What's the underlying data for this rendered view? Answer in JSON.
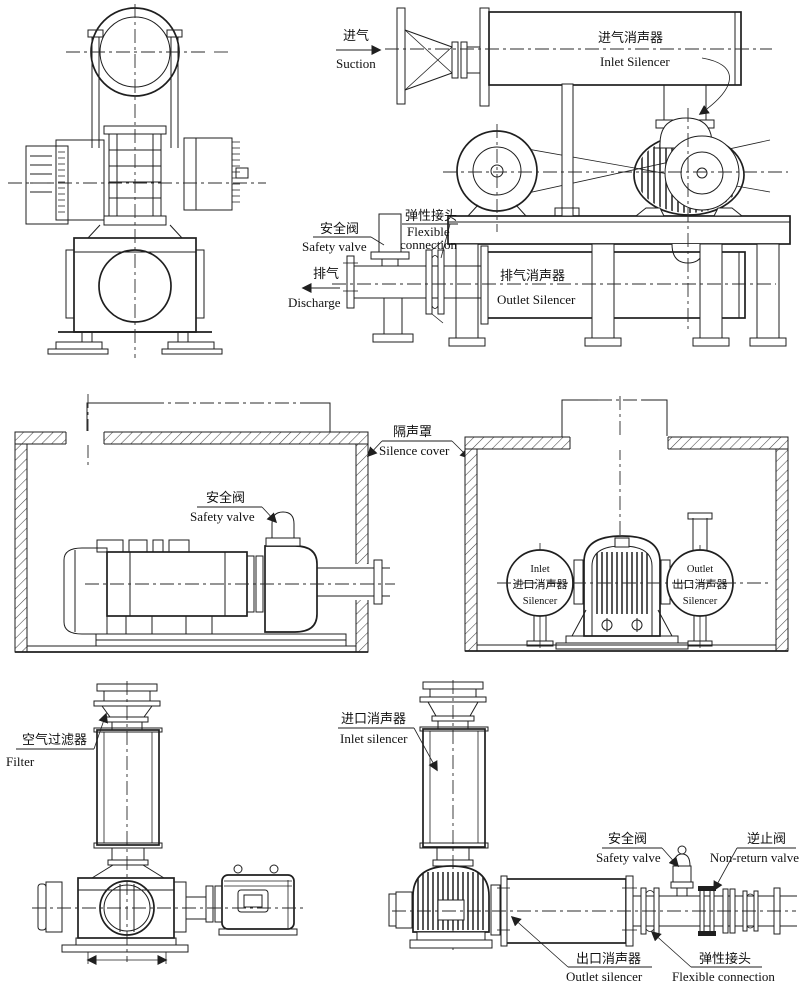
{
  "background": "#ffffff",
  "ink": "#1f1f1f",
  "figures": {
    "side_installation": {
      "suction_cn": "进气",
      "suction_en": "Suction",
      "inlet_silencer_cn": "进气消声器",
      "inlet_silencer_en": "Inlet Silencer",
      "safety_valve_cn": "安全阀",
      "safety_valve_en": "Safety valve",
      "flexible_cn": "弹性接头",
      "flexible_en_line1": "Flexible",
      "flexible_en_line2": "connection",
      "discharge_cn": "排气",
      "discharge_en": "Discharge",
      "outlet_silencer_cn": "排气消声器",
      "outlet_silencer_en": "Outlet Silencer"
    },
    "silence_cover": {
      "cn": "隔声罩",
      "en": "Silence cover"
    },
    "enclosure_left": {
      "safety_valve_cn": "安全阀",
      "safety_valve_en": "Safety valve"
    },
    "enclosure_right": {
      "inlet_line1": "Inlet",
      "inlet_cn": "进口消声器",
      "inlet_line2": "Silencer",
      "outlet_line1": "Outlet",
      "outlet_cn": "出口消声器",
      "outlet_line2": "Silencer"
    },
    "vertical_filter_unit": {
      "filter_cn": "空气过滤器",
      "filter_en": "Filter"
    },
    "vertical_silencer_unit": {
      "inlet_silencer_cn": "进口消声器",
      "inlet_silencer_en": "Inlet silencer",
      "safety_valve_cn": "安全阀",
      "safety_valve_en": "Safety valve",
      "non_return_cn": "逆止阀",
      "non_return_en": "Non-return valve",
      "outlet_silencer_cn": "出口消声器",
      "outlet_silencer_en": "Outlet silencer",
      "flexible_cn": "弹性接头",
      "flexible_en": "Flexible connection"
    }
  }
}
